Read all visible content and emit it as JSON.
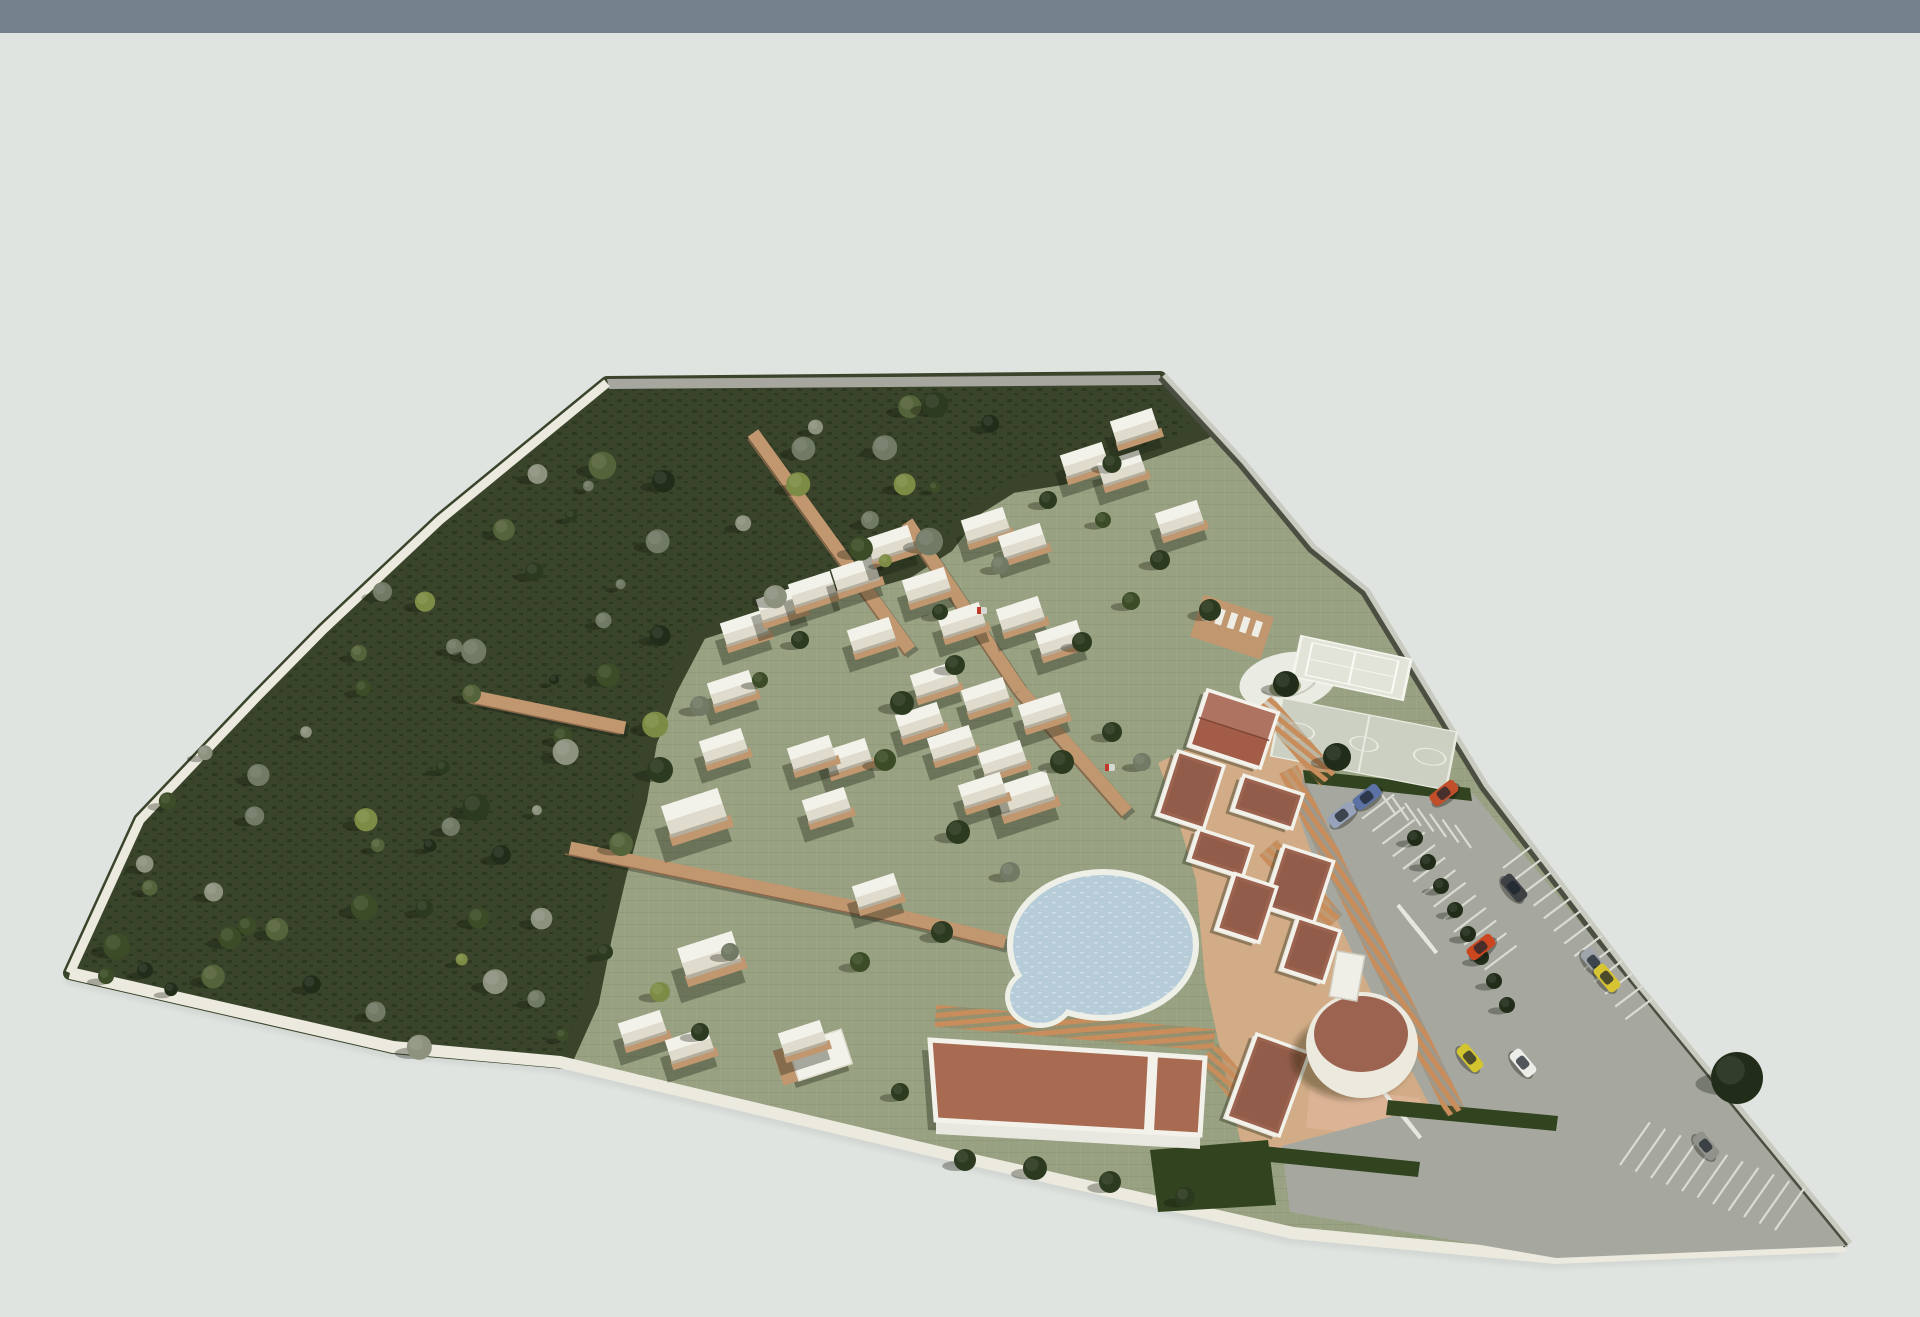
{
  "scene_type": "3d-architectural-site-plan-render",
  "canvas": {
    "w": 1920,
    "h": 1317
  },
  "colors": {
    "skyBar": "#75818b",
    "bg": "#dfe4e0",
    "bgLow": "#e4e8e4",
    "lawn": "#98a181",
    "lawnLight": "#a4ac8c",
    "forest": "#39442b",
    "forestDark": "#2d3820",
    "road": "#a7a7a0",
    "curb": "#eceadf",
    "wall": "#4a4f42",
    "wallLight": "#c9cbc1",
    "walk": "#c0976f",
    "walkEdge": "#8b684a",
    "plaza": "#d6ac87",
    "plazaPink": "#dcb394",
    "pergola": "#c98d5b",
    "terra": "#9c6450",
    "terraLight": "#a86b52",
    "gableRoof": "#a25c47",
    "white": "#f3f2ea",
    "whiteShade": "#e0dccd",
    "poolRim": "#eef0e8",
    "water": "#b6ccd9",
    "waterDot": "#cfdde6",
    "asphalt": "#a6a8a0",
    "asphaltLight": "#c6c8bf",
    "stall": "#dadcd3",
    "courtTennis": "#e2e4da",
    "courtBasket": "#ccd0c2",
    "plazaCircle": "#eaece3",
    "hedge": "#31431f",
    "shadow": "rgba(24,28,14,0.35)",
    "treePalette": [
      "#222d19",
      "#2c3a1f",
      "#3c4c27",
      "#55633a",
      "#707a64",
      "#8d927f",
      "#7c8c44"
    ]
  },
  "sky_bar_h": 33,
  "site_outline": [
    [
      607,
      383
    ],
    [
      1160,
      378
    ],
    [
      1240,
      465
    ],
    [
      1310,
      550
    ],
    [
      1363,
      593
    ],
    [
      1482,
      788
    ],
    [
      1632,
      985
    ],
    [
      1846,
      1246
    ],
    [
      1556,
      1258
    ],
    [
      1293,
      1233
    ],
    [
      938,
      1152
    ],
    [
      560,
      1062
    ],
    [
      393,
      1047
    ],
    [
      70,
      973
    ],
    [
      140,
      820
    ],
    [
      257,
      697
    ],
    [
      323,
      630
    ],
    [
      440,
      520
    ]
  ],
  "forest_poly": [
    [
      607,
      383
    ],
    [
      1160,
      378
    ],
    [
      1205,
      432
    ],
    [
      1120,
      462
    ],
    [
      1062,
      478
    ],
    [
      1012,
      486
    ],
    [
      977,
      508
    ],
    [
      947,
      546
    ],
    [
      908,
      571
    ],
    [
      822,
      596
    ],
    [
      768,
      611
    ],
    [
      700,
      633
    ],
    [
      670,
      690
    ],
    [
      650,
      742
    ],
    [
      640,
      800
    ],
    [
      620,
      873
    ],
    [
      605,
      937
    ],
    [
      592,
      1002
    ],
    [
      565,
      1062
    ],
    [
      393,
      1047
    ],
    [
      70,
      973
    ],
    [
      140,
      820
    ],
    [
      257,
      697
    ],
    [
      323,
      630
    ],
    [
      440,
      520
    ]
  ],
  "top_road": [
    [
      607,
      379
    ],
    [
      1160,
      375
    ],
    [
      1162,
      385
    ],
    [
      609,
      389
    ]
  ],
  "curb_left": [
    [
      607,
      383
    ],
    [
      440,
      520
    ],
    [
      323,
      630
    ],
    [
      257,
      697
    ],
    [
      140,
      820
    ],
    [
      70,
      973
    ]
  ],
  "curb_bottom": [
    [
      70,
      973
    ],
    [
      393,
      1047
    ],
    [
      560,
      1062
    ],
    [
      938,
      1152
    ],
    [
      1293,
      1233
    ],
    [
      1556,
      1258
    ],
    [
      1846,
      1246
    ]
  ],
  "wall_line": [
    [
      1160,
      378
    ],
    [
      1240,
      465
    ],
    [
      1310,
      550
    ],
    [
      1363,
      593
    ],
    [
      1482,
      788
    ],
    [
      1632,
      985
    ],
    [
      1846,
      1246
    ]
  ],
  "walkways": [
    [
      907,
      522,
      1020,
      690
    ],
    [
      1020,
      690,
      1127,
      812
    ],
    [
      753,
      433,
      910,
      650
    ],
    [
      570,
      848,
      908,
      918
    ],
    [
      475,
      697,
      625,
      728
    ],
    [
      908,
      918,
      1005,
      942
    ]
  ],
  "cabins": [
    [
      745,
      630,
      1
    ],
    [
      781,
      606,
      1
    ],
    [
      813,
      591,
      1
    ],
    [
      856,
      576,
      1
    ],
    [
      891,
      545,
      1
    ],
    [
      927,
      587,
      1
    ],
    [
      872,
      637,
      1
    ],
    [
      962,
      622,
      1
    ],
    [
      986,
      527,
      1
    ],
    [
      1023,
      543,
      1
    ],
    [
      1021,
      616,
      1
    ],
    [
      1060,
      640,
      1
    ],
    [
      1085,
      462,
      1
    ],
    [
      1122,
      470,
      1
    ],
    [
      1135,
      428,
      1
    ],
    [
      1180,
      520,
      1
    ],
    [
      935,
      682,
      1
    ],
    [
      986,
      697,
      1
    ],
    [
      1043,
      712,
      1
    ],
    [
      920,
      722,
      1
    ],
    [
      952,
      745,
      1
    ],
    [
      1003,
      760,
      1
    ],
    [
      1025,
      795,
      1.25
    ],
    [
      848,
      758,
      1
    ],
    [
      812,
      755,
      1
    ],
    [
      827,
      807,
      1
    ],
    [
      724,
      748,
      1
    ],
    [
      732,
      690,
      1
    ],
    [
      695,
      815,
      1.35
    ],
    [
      710,
      957,
      1.3
    ],
    [
      877,
      893,
      1
    ],
    [
      643,
      1030,
      1
    ],
    [
      690,
      1047,
      1
    ],
    [
      803,
      1040,
      1
    ],
    [
      983,
      792,
      1
    ]
  ],
  "small_building": {
    "x": 820,
    "y": 1055,
    "w": 56,
    "h": 36,
    "rot": -18
  },
  "pool": {
    "cx": 1103,
    "cy": 945,
    "rx": 90,
    "ry": 70,
    "scx": 1040,
    "scy": 997,
    "srx": 30,
    "sry": 26
  },
  "hall": {
    "roof": [
      [
        930,
        1040
      ],
      [
        1205,
        1058
      ],
      [
        1200,
        1135
      ],
      [
        936,
        1120
      ]
    ],
    "wallFace": [
      [
        936,
        1120
      ],
      [
        1200,
        1135
      ],
      [
        1200,
        1149
      ],
      [
        936,
        1134
      ]
    ],
    "stripe": [
      [
        1148,
        1054
      ],
      [
        1158,
        1055
      ],
      [
        1154,
        1131
      ],
      [
        1144,
        1130
      ]
    ]
  },
  "annex": {
    "x": 1268,
    "y": 1085,
    "w": 56,
    "h": 88,
    "rot": 20
  },
  "round_building": {
    "cx": 1362,
    "cy": 1045,
    "rx": 56,
    "ry": 53,
    "trx": 47,
    "try": 38,
    "box": {
      "x": 1347,
      "y": 976,
      "w": 28,
      "h": 46,
      "rot": 10
    }
  },
  "cluster": [
    {
      "x": 1234,
      "y": 729,
      "w": 74,
      "h": 58,
      "rot": 18,
      "gable": true
    },
    {
      "x": 1191,
      "y": 790,
      "w": 48,
      "h": 66,
      "rot": 18
    },
    {
      "x": 1268,
      "y": 802,
      "w": 62,
      "h": 36,
      "rot": 18
    },
    {
      "x": 1221,
      "y": 853,
      "w": 56,
      "h": 32,
      "rot": 18
    },
    {
      "x": 1299,
      "y": 884,
      "w": 52,
      "h": 64,
      "rot": 18
    },
    {
      "x": 1247,
      "y": 908,
      "w": 44,
      "h": 58,
      "rot": 18
    },
    {
      "x": 1311,
      "y": 950,
      "w": 44,
      "h": 54,
      "rot": 18
    }
  ],
  "plaza_poly": [
    [
      1158,
      763
    ],
    [
      1282,
      703
    ],
    [
      1332,
      765
    ],
    [
      1372,
      990
    ],
    [
      1455,
      1112
    ],
    [
      1295,
      1165
    ],
    [
      1240,
      1140
    ],
    [
      1205,
      980
    ],
    [
      1196,
      880
    ],
    [
      1172,
      800
    ]
  ],
  "pink_path": [
    [
      1310,
      1086
    ],
    [
      1420,
      1098
    ],
    [
      1416,
      1140
    ],
    [
      1306,
      1128
    ]
  ],
  "gate_plaza": [
    [
      1282,
      1146
    ],
    [
      1452,
      1120
    ],
    [
      1468,
      1172
    ],
    [
      1296,
      1212
    ]
  ],
  "pergolas": [
    {
      "x": 1296,
      "y": 741,
      "len": 100,
      "wid": 22,
      "rot": 49
    },
    {
      "x": 1301,
      "y": 885,
      "len": 100,
      "wid": 24,
      "rot": 49
    },
    {
      "x": 1372,
      "y": 941,
      "len": 382,
      "wid": 20,
      "rot": 64
    },
    {
      "x": 1075,
      "y": 1028,
      "len": 280,
      "wid": 22,
      "rot": 5
    },
    {
      "x": 1237,
      "y": 1087,
      "len": 90,
      "wid": 26,
      "rot": 50
    }
  ],
  "hedges": [
    [
      [
        1303,
        770
      ],
      [
        1470,
        788
      ],
      [
        1472,
        801
      ],
      [
        1305,
        783
      ]
    ],
    [
      [
        1388,
        1100
      ],
      [
        1558,
        1116
      ],
      [
        1556,
        1131
      ],
      [
        1386,
        1115
      ]
    ],
    [
      [
        1262,
        1146
      ],
      [
        1420,
        1162
      ],
      [
        1418,
        1177
      ],
      [
        1260,
        1161
      ]
    ],
    [
      [
        1150,
        1150
      ],
      [
        1268,
        1140
      ],
      [
        1276,
        1205
      ],
      [
        1158,
        1212
      ]
    ]
  ],
  "courts": {
    "circle_plaza": {
      "cx": 1288,
      "cy": 681,
      "r": 49,
      "rot": -10,
      "sy": 0.58
    },
    "tennis": {
      "cx": 1352,
      "cy": 668,
      "w": 112,
      "h": 76,
      "rot": 12,
      "sy": 0.55
    },
    "basketball": {
      "cx": 1364,
      "cy": 744,
      "w": 178,
      "h": 118,
      "rot": 11,
      "sy": 0.5
    },
    "sunbed_deck": {
      "x": 1232,
      "y": 627,
      "w": 74,
      "h": 44,
      "rot": 18
    }
  },
  "parking": {
    "poly": [
      [
        1303,
        770
      ],
      [
        1470,
        790
      ],
      [
        1632,
        985
      ],
      [
        1846,
        1246
      ],
      [
        1556,
        1258
      ],
      [
        1290,
        1212
      ],
      [
        1282,
        1146
      ],
      [
        1430,
        1106
      ],
      [
        1380,
        1010
      ],
      [
        1330,
        905
      ],
      [
        1300,
        820
      ]
    ],
    "stall_rows": [
      {
        "x": 1352,
        "y": 806,
        "dx": 10.2,
        "dy": 12.6,
        "n": 14,
        "len": 40,
        "ang": -37
      },
      {
        "x": 1503,
        "y": 868,
        "dx": 10.2,
        "dy": 12.6,
        "n": 13,
        "len": 34,
        "ang": -37
      },
      {
        "x": 1380,
        "y": 792,
        "dx": 12.5,
        "dy": 5.5,
        "n": 7,
        "len": 28,
        "ang": 55
      },
      {
        "x": 1620,
        "y": 1165,
        "dx": 15.5,
        "dy": 6.5,
        "n": 11,
        "len": 52,
        "ang": -55
      }
    ],
    "crosswalks": [
      {
        "x": 1398,
        "y": 905,
        "dx": 4.5,
        "dy": 5.5,
        "n": 6,
        "len": 26,
        "ang": 52
      },
      {
        "x": 1382,
        "y": 1090,
        "dx": 4.5,
        "dy": 5.5,
        "n": 6,
        "len": 26,
        "ang": 52
      }
    ],
    "cars": [
      [
        1342,
        815,
        -38,
        "#97a2bb"
      ],
      [
        1367,
        797,
        -38,
        "#5d72a4"
      ],
      [
        1444,
        793,
        -38,
        "#c14f2c"
      ],
      [
        1514,
        888,
        50,
        "#3e4144"
      ],
      [
        1481,
        947,
        -38,
        "#cc4720"
      ],
      [
        1594,
        962,
        50,
        "#a0a5ac"
      ],
      [
        1607,
        978,
        50,
        "#d6c433"
      ],
      [
        1470,
        1058,
        50,
        "#d2c52f"
      ],
      [
        1523,
        1063,
        50,
        "#ecece8"
      ],
      [
        1706,
        1146,
        50,
        "#90928b"
      ]
    ],
    "median_trees": [
      [
        1415,
        838
      ],
      [
        1428,
        862
      ],
      [
        1441,
        886
      ],
      [
        1455,
        910
      ],
      [
        1468,
        934
      ],
      [
        1481,
        957
      ],
      [
        1494,
        981
      ],
      [
        1507,
        1005
      ]
    ],
    "big_tree": [
      1737,
      1078,
      26
    ]
  },
  "lawn_trees": [
    [
      660,
      770,
      13,
      1
    ],
    [
      700,
      706,
      10,
      4
    ],
    [
      902,
      703,
      12,
      1
    ],
    [
      955,
      665,
      10,
      1
    ],
    [
      1000,
      565,
      9,
      4
    ],
    [
      940,
      612,
      8,
      1
    ],
    [
      885,
      760,
      11,
      2
    ],
    [
      958,
      832,
      12,
      1
    ],
    [
      1010,
      872,
      10,
      4
    ],
    [
      942,
      932,
      11,
      1
    ],
    [
      860,
      962,
      10,
      2
    ],
    [
      1062,
      762,
      12,
      1
    ],
    [
      1112,
      732,
      10,
      1
    ],
    [
      1142,
      762,
      9,
      4
    ],
    [
      1082,
      642,
      10,
      1
    ],
    [
      1131,
      601,
      9,
      2
    ],
    [
      730,
      952,
      9,
      4
    ],
    [
      700,
      1032,
      9,
      1
    ],
    [
      660,
      992,
      10,
      6
    ],
    [
      605,
      952,
      8,
      1
    ],
    [
      1337,
      757,
      14,
      0
    ],
    [
      1286,
      684,
      13,
      0
    ],
    [
      965,
      1160,
      11,
      1
    ],
    [
      1035,
      1168,
      12,
      1
    ],
    [
      1110,
      1182,
      11,
      1
    ],
    [
      1185,
      1197,
      10,
      1
    ],
    [
      900,
      1092,
      9,
      1
    ],
    [
      1048,
      500,
      9,
      1
    ],
    [
      1103,
      520,
      8,
      2
    ],
    [
      1160,
      560,
      10,
      1
    ],
    [
      1210,
      610,
      11,
      1
    ],
    [
      870,
      520,
      9,
      4
    ],
    [
      800,
      640,
      9,
      1
    ],
    [
      760,
      680,
      8,
      2
    ]
  ],
  "forest_grid": {
    "x0": 96,
    "y0": 400,
    "dx": 57,
    "dy": 46,
    "cols": 23,
    "rows": 16,
    "jitter": 24
  },
  "carts": [
    [
      982,
      610
    ],
    [
      1110,
      767
    ]
  ]
}
